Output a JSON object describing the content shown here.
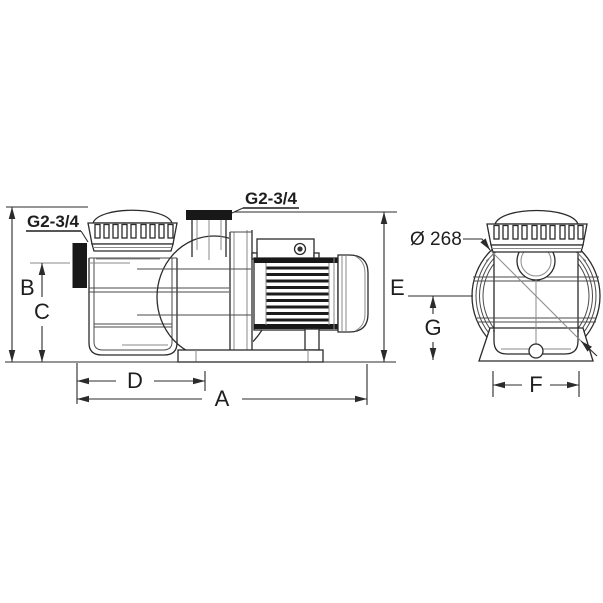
{
  "figure": {
    "type": "technical-dimension-drawing",
    "subject": "pump side and front views",
    "side_view": {
      "inlet_port_label": "G2-3/4",
      "outlet_port_label": "G2-3/4",
      "dimensions": [
        {
          "key": "B"
        },
        {
          "key": "C"
        },
        {
          "key": "D"
        },
        {
          "key": "A"
        },
        {
          "key": "E"
        }
      ]
    },
    "front_view": {
      "diameter_label": "Ø 268",
      "dimensions": [
        {
          "key": "G"
        },
        {
          "key": "F"
        }
      ]
    },
    "colors": {
      "line": "#2b2b2b",
      "background": "#ffffff",
      "solid_fill": "#181818",
      "faint_line": "#8a8a8a"
    }
  }
}
